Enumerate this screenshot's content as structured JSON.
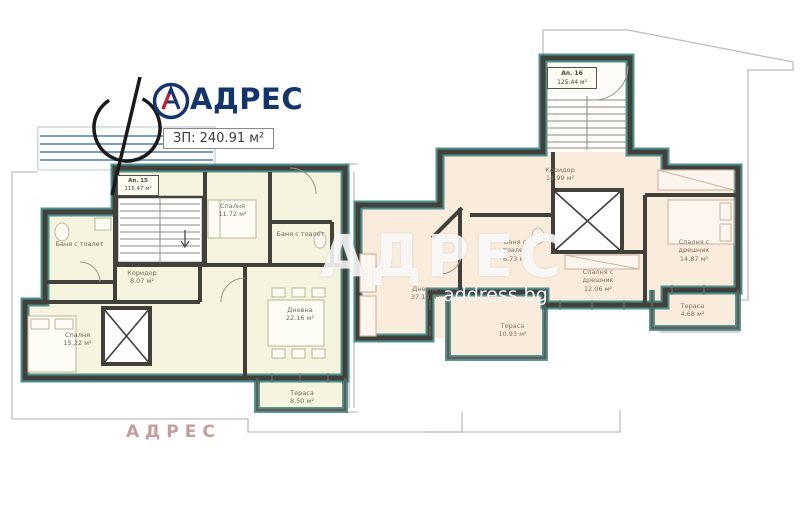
{
  "header": {
    "brand": "АДРЕС",
    "total_area": "ЗП: 240.91 м²"
  },
  "apartments": {
    "left": {
      "unit": {
        "name": "Ап. 15",
        "area": "115.47 м²"
      },
      "rooms": [
        {
          "name": "Баня с тоалет",
          "area": ""
        },
        {
          "name": "Спалня",
          "area": "11.72 м²"
        },
        {
          "name": "Баня с тоалет",
          "area": ""
        },
        {
          "name": "Коридор",
          "area": "8.07 м²"
        },
        {
          "name": "Дневна",
          "area": "22.16 м²"
        },
        {
          "name": "Спалня",
          "area": "15.22 м²"
        },
        {
          "name": "Тераса",
          "area": "8.50 м²"
        }
      ]
    },
    "right": {
      "unit": {
        "name": "Ап. 16",
        "area": "125.44 м²"
      },
      "rooms": [
        {
          "name": "Коридор",
          "area": "14.99 м²"
        },
        {
          "name": "Дневна",
          "area": "37.19 м²"
        },
        {
          "name": "Баня с тоалет",
          "area": "6.73 м²"
        },
        {
          "name": "Спалня с дрешник",
          "area": "12.06 м²"
        },
        {
          "name": "Спалня с дрешник",
          "area": "14.87 м²"
        },
        {
          "name": "Тераса",
          "area": "10.93 м²"
        },
        {
          "name": "Тераса",
          "area": "4.68 м²"
        }
      ]
    }
  },
  "watermarks": {
    "center": "АДРЕС",
    "center_sub": "address bg",
    "bottom": "АДРЕС"
  },
  "icons": {
    "logo_mark": "circled-a-icon",
    "compass_mark": "section-compass-icon"
  },
  "colors": {
    "brand_navy": "#14356b",
    "brand_red": "#c21f30",
    "floor_left": "#f6f3de",
    "floor_right": "#f9ecdc",
    "wall": "#42403b",
    "wall_accent_teal": "#2e7f7e",
    "outline_gray": "#bdbdbd",
    "watermark_pink": "#c79c9c"
  }
}
